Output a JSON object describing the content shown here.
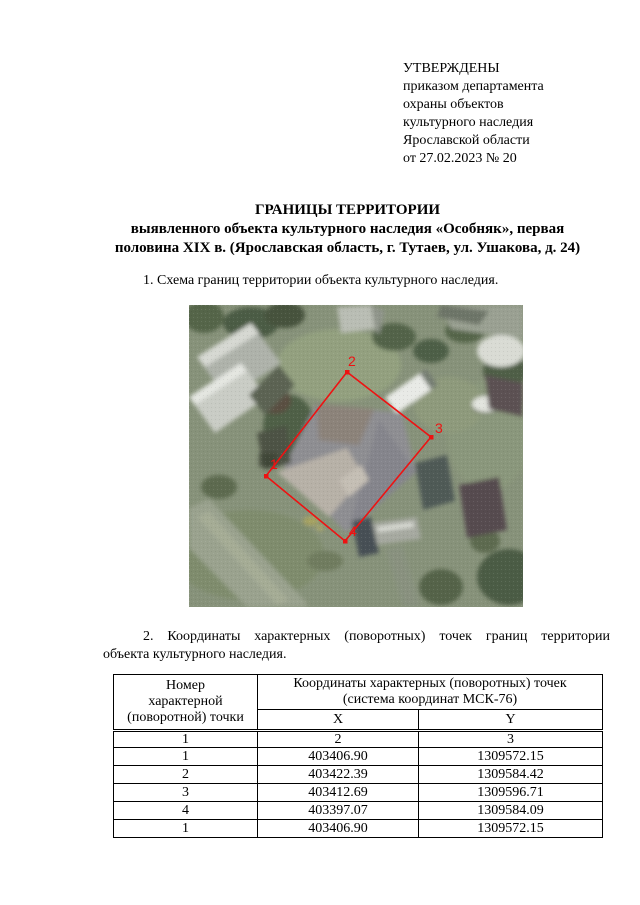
{
  "approval": {
    "lines": [
      "УТВЕРЖДЕНЫ",
      "приказом департамента",
      "охраны объектов",
      "культурного наследия",
      "Ярославской области",
      "от 27.02.2023 № 20"
    ]
  },
  "title": {
    "lines": [
      "ГРАНИЦЫ ТЕРРИТОРИИ",
      "выявленного объекта культурного наследия «Особняк», первая",
      "половина XIX в. (Ярославская область, г. Тутаев, ул. Ушакова, д. 24)"
    ]
  },
  "section1": {
    "text": "1. Схема границ территории объекта культурного наследия."
  },
  "map": {
    "type": "satellite-scheme",
    "boundary_color": "#ee1212",
    "point_labels": [
      "1",
      "2",
      "3",
      "4"
    ]
  },
  "section2": {
    "line1": "2. Координаты характерных (поворотных) точек границ территории",
    "line2": "объекта культурного наследия."
  },
  "table": {
    "header": {
      "col1_lines": [
        "Номер",
        "характерной",
        "(поворотной) точки"
      ],
      "col2_lines": [
        "Координаты характерных (поворотных) точек",
        "(система координат МСК-76)"
      ],
      "x": "X",
      "y": "Y"
    },
    "numbering": [
      "1",
      "2",
      "3"
    ],
    "rows": [
      [
        "1",
        "403406.90",
        "1309572.15"
      ],
      [
        "2",
        "403422.39",
        "1309584.42"
      ],
      [
        "3",
        "403412.69",
        "1309596.71"
      ],
      [
        "4",
        "403397.07",
        "1309584.09"
      ],
      [
        "1",
        "403406.90",
        "1309572.15"
      ]
    ]
  }
}
